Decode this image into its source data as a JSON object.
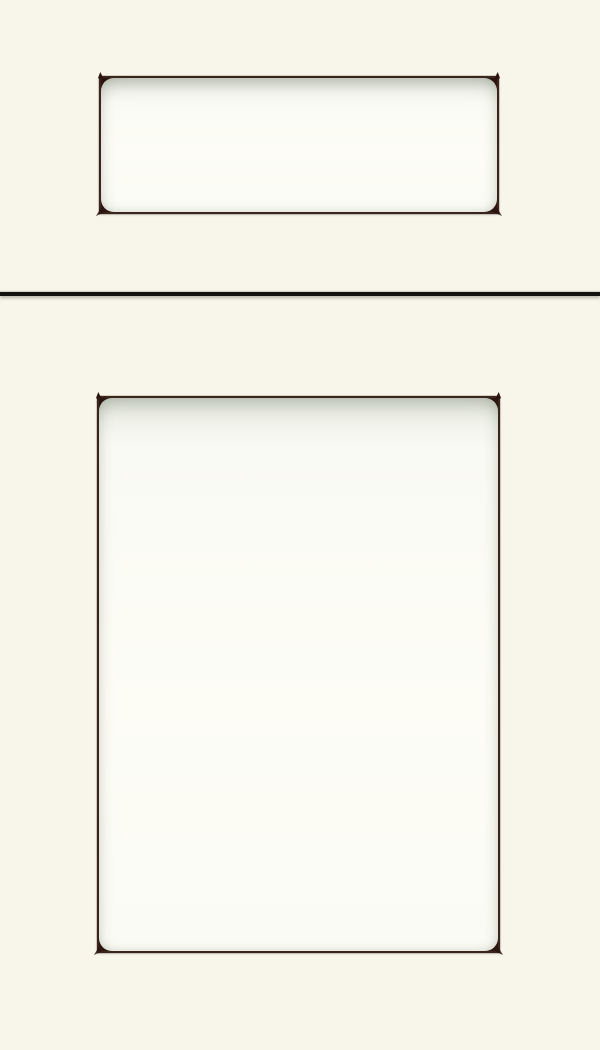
{
  "meta": {
    "kind": "product-image",
    "description": "Cabinet sample showing a drawer front (top) and door front (bottom), white painted finish, recessed flat panels outlined by thin dark glaze lines with distressed dark corner accents, separated by a dark horizontal gap line"
  },
  "colors": {
    "background": "#F8F6EB",
    "panel_fill": "#FDFDF6",
    "frame_line": "#3B241C",
    "corner_accent": "#2B150E",
    "gap_line": "#121211"
  }
}
